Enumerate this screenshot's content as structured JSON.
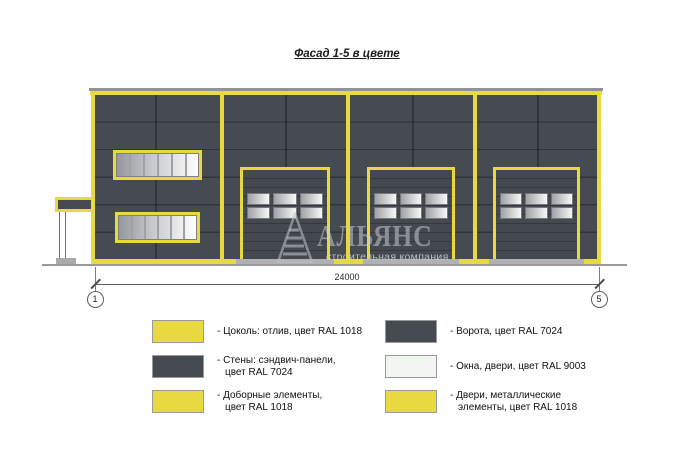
{
  "drawing": {
    "title": "Фасад 1-5 в цвете",
    "dimension_label": "24000",
    "axis_marker_left": "1",
    "axis_marker_right": "5"
  },
  "watermark": {
    "brand": "АЛЬЯНС",
    "tagline": "строительная компания"
  },
  "palette": {
    "ral_1018_yellow": "#E7D93F",
    "ral_7024_graphite": "#464A51",
    "ral_9003_signal_white": "#F0F5EF",
    "window_glass_gradient_start": "#9FA2A7",
    "window_glass_gradient_end": "#FFFFFF"
  },
  "legend": {
    "columns": [
      {
        "items": [
          {
            "color": "#E7D93F",
            "label": "- Цоколь: отлив, цвет RAL 1018"
          },
          {
            "color": "#464A51",
            "label": "- Стены: сэндвич-панели,\nцвет RAL 7024"
          },
          {
            "color": "#E7D93F",
            "label": "- Доборные элементы,\nцвет RAL 1018"
          }
        ]
      },
      {
        "items": [
          {
            "color": "#464A51",
            "label": "- Ворота, цвет RAL 7024"
          },
          {
            "color": "#F0F5EF",
            "label": "- Окна, двери, цвет RAL 9003"
          },
          {
            "color": "#E7D93F",
            "label": "- Двери, металлические\nэлементы, цвет RAL 1018"
          }
        ]
      }
    ]
  }
}
